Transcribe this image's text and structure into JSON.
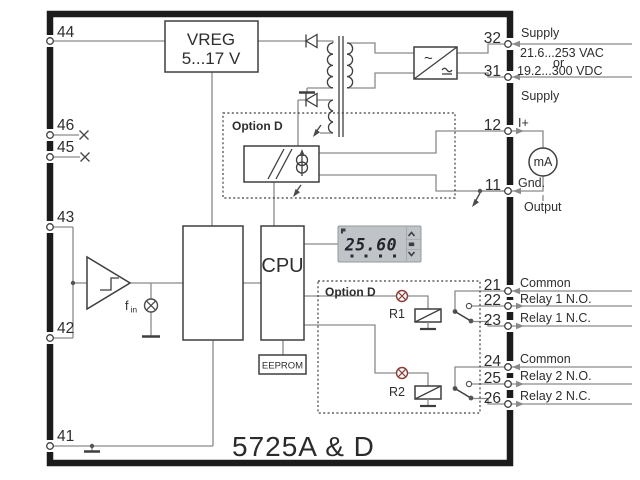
{
  "title": "5725A & D",
  "blocks": {
    "vreg_line1": "VREG",
    "vreg_line2": "5...17 V",
    "cpu": "CPU",
    "eeprom": "EEPROM",
    "option_d_analog": "Option D",
    "option_d_relay": "Option D",
    "relay1": "R1",
    "relay2": "R2",
    "fin_base": "f",
    "fin_sub": "in",
    "meter": "mA",
    "ac_symbol": "~"
  },
  "display": {
    "value": "25.60"
  },
  "terminals": {
    "left": [
      {
        "num": "44"
      },
      {
        "num": "46"
      },
      {
        "num": "45"
      },
      {
        "num": "43"
      },
      {
        "num": "42"
      },
      {
        "num": "41"
      }
    ],
    "right": [
      {
        "num": "32",
        "label": "Supply"
      },
      {
        "num": "31",
        "label": "Supply"
      },
      {
        "num": "12",
        "label": "I+"
      },
      {
        "num": "11",
        "label": "Gnd."
      },
      {
        "num": "21",
        "label": "Common"
      },
      {
        "num": "22",
        "label": "Relay 1 N.O."
      },
      {
        "num": "23",
        "label": "Relay 1 N.C."
      },
      {
        "num": "24",
        "label": "Common"
      },
      {
        "num": "25",
        "label": "Relay 2 N.O."
      },
      {
        "num": "26",
        "label": "Relay 2 N.C."
      }
    ]
  },
  "supply": {
    "voltage_ac": "21.6...253 VAC",
    "or_word": "or",
    "voltage_dc": "19.2...300 VDC"
  },
  "output_label": "Output",
  "colors": {
    "wire": "#8a8a8a",
    "component_stroke": "#3f3f3f",
    "frame": "#1c1c1c",
    "text": "#2e2e2e",
    "relay_lamp": "#8a3c34",
    "display_bg": "#c0c4c8"
  }
}
